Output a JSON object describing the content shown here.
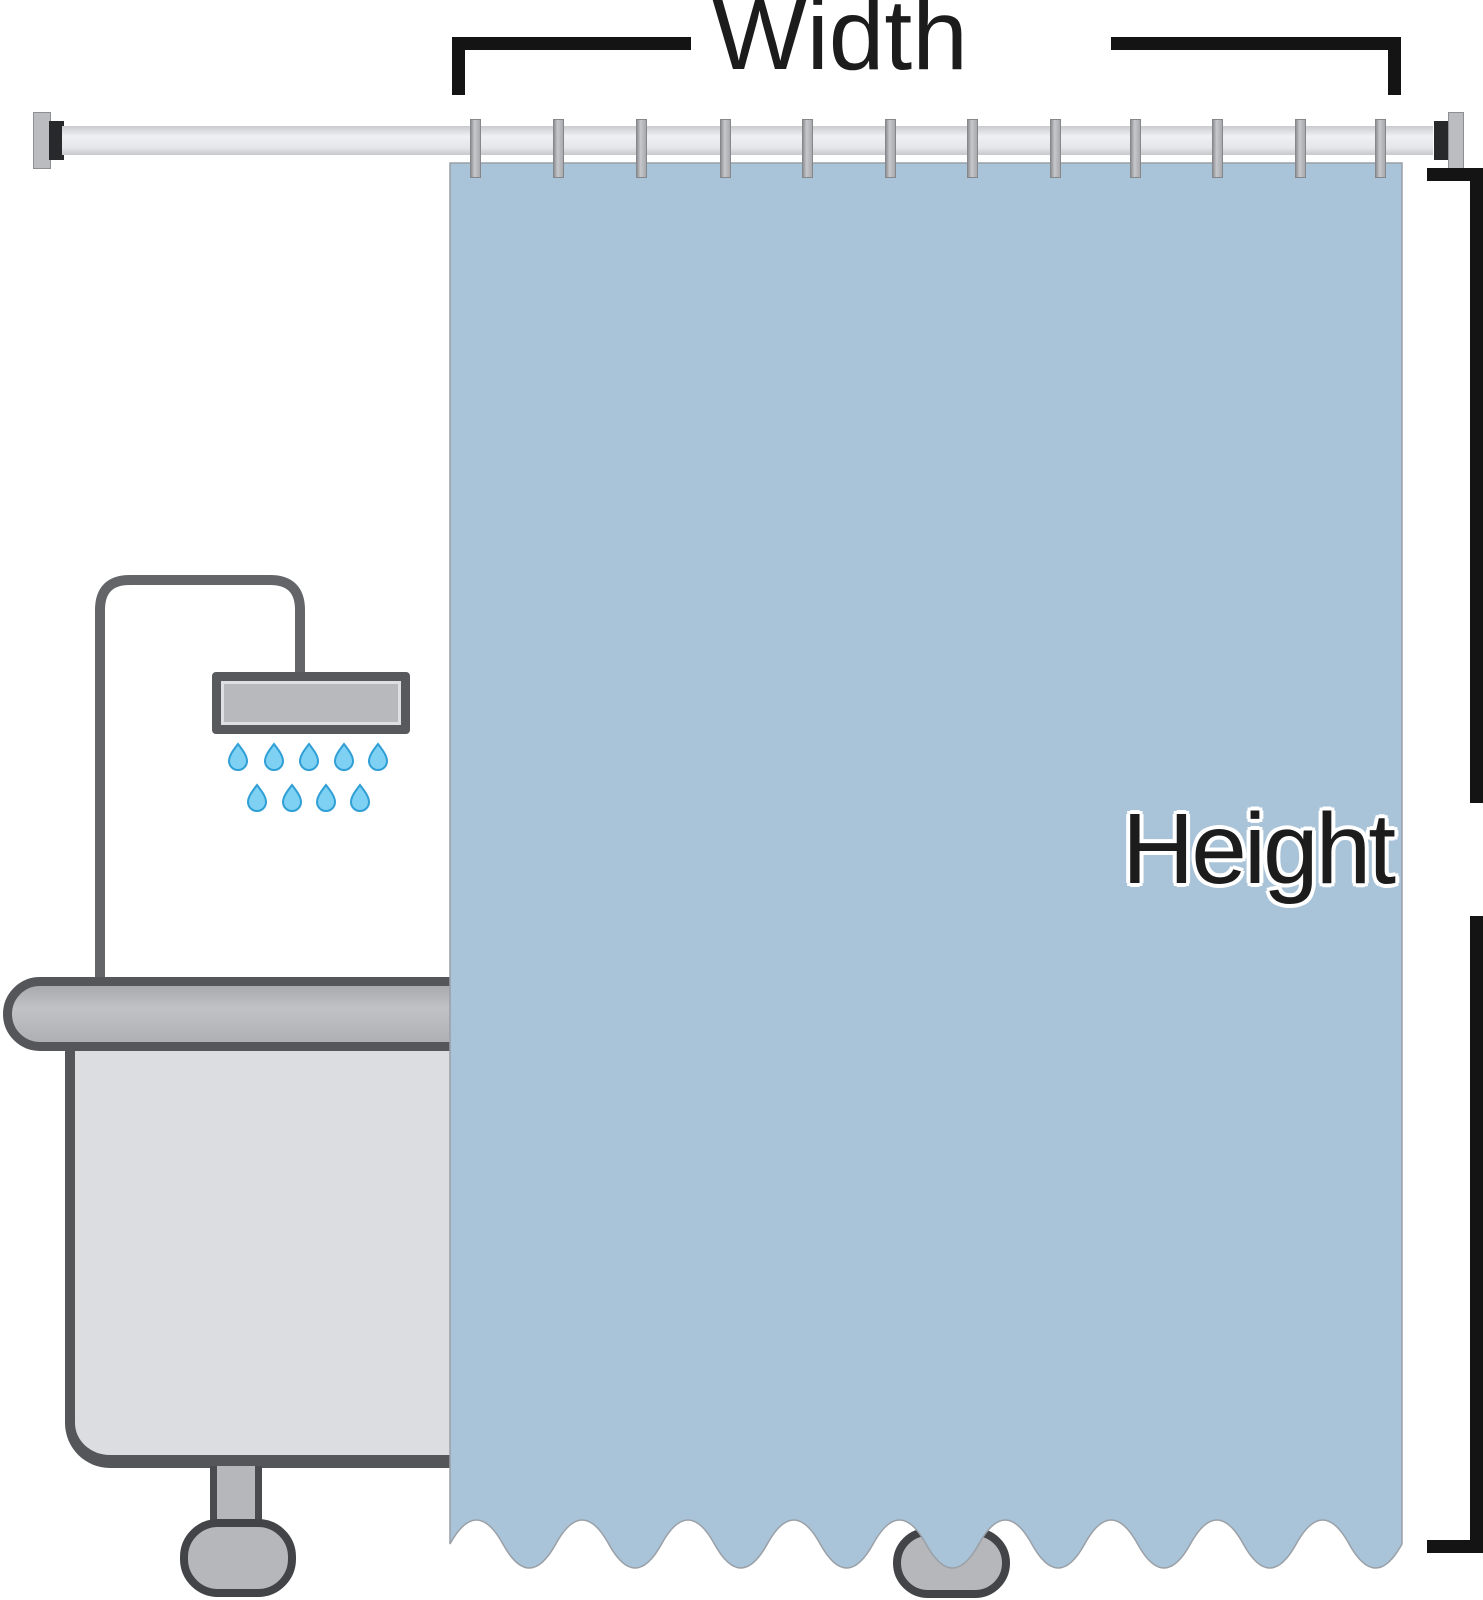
{
  "page": {
    "background": "#ffffff"
  },
  "diagram": {
    "labels": {
      "width": "Width",
      "height": "Height"
    },
    "curtain": {
      "color": "#a9c3d9",
      "edge_color": "#9aa0a6",
      "hook_count": 12
    },
    "hooks_x": [
      476,
      559,
      642,
      726,
      808,
      891,
      973,
      1056,
      1136,
      1218,
      1301,
      1381
    ],
    "water_drops": {
      "fill": "#7ed1f2",
      "outline": "#2f9fd6",
      "row1": {
        "y": 756,
        "x": [
          238,
          274,
          309,
          344,
          378
        ]
      },
      "row2": {
        "y": 797,
        "x": [
          257,
          292,
          326,
          360
        ]
      }
    },
    "annotation_color": "#141414",
    "fixtures": {
      "rod_color": "#e7e9ec",
      "hook_color": "#b3b5b9",
      "pipe_color": "#646569",
      "shower_head_fill": "#b8b9bc",
      "tub_fill": "#dcdde0",
      "tub_border": "#55565a",
      "rail_fill": "#b5b7ba",
      "foot_fill": "#b5b7ba"
    }
  }
}
